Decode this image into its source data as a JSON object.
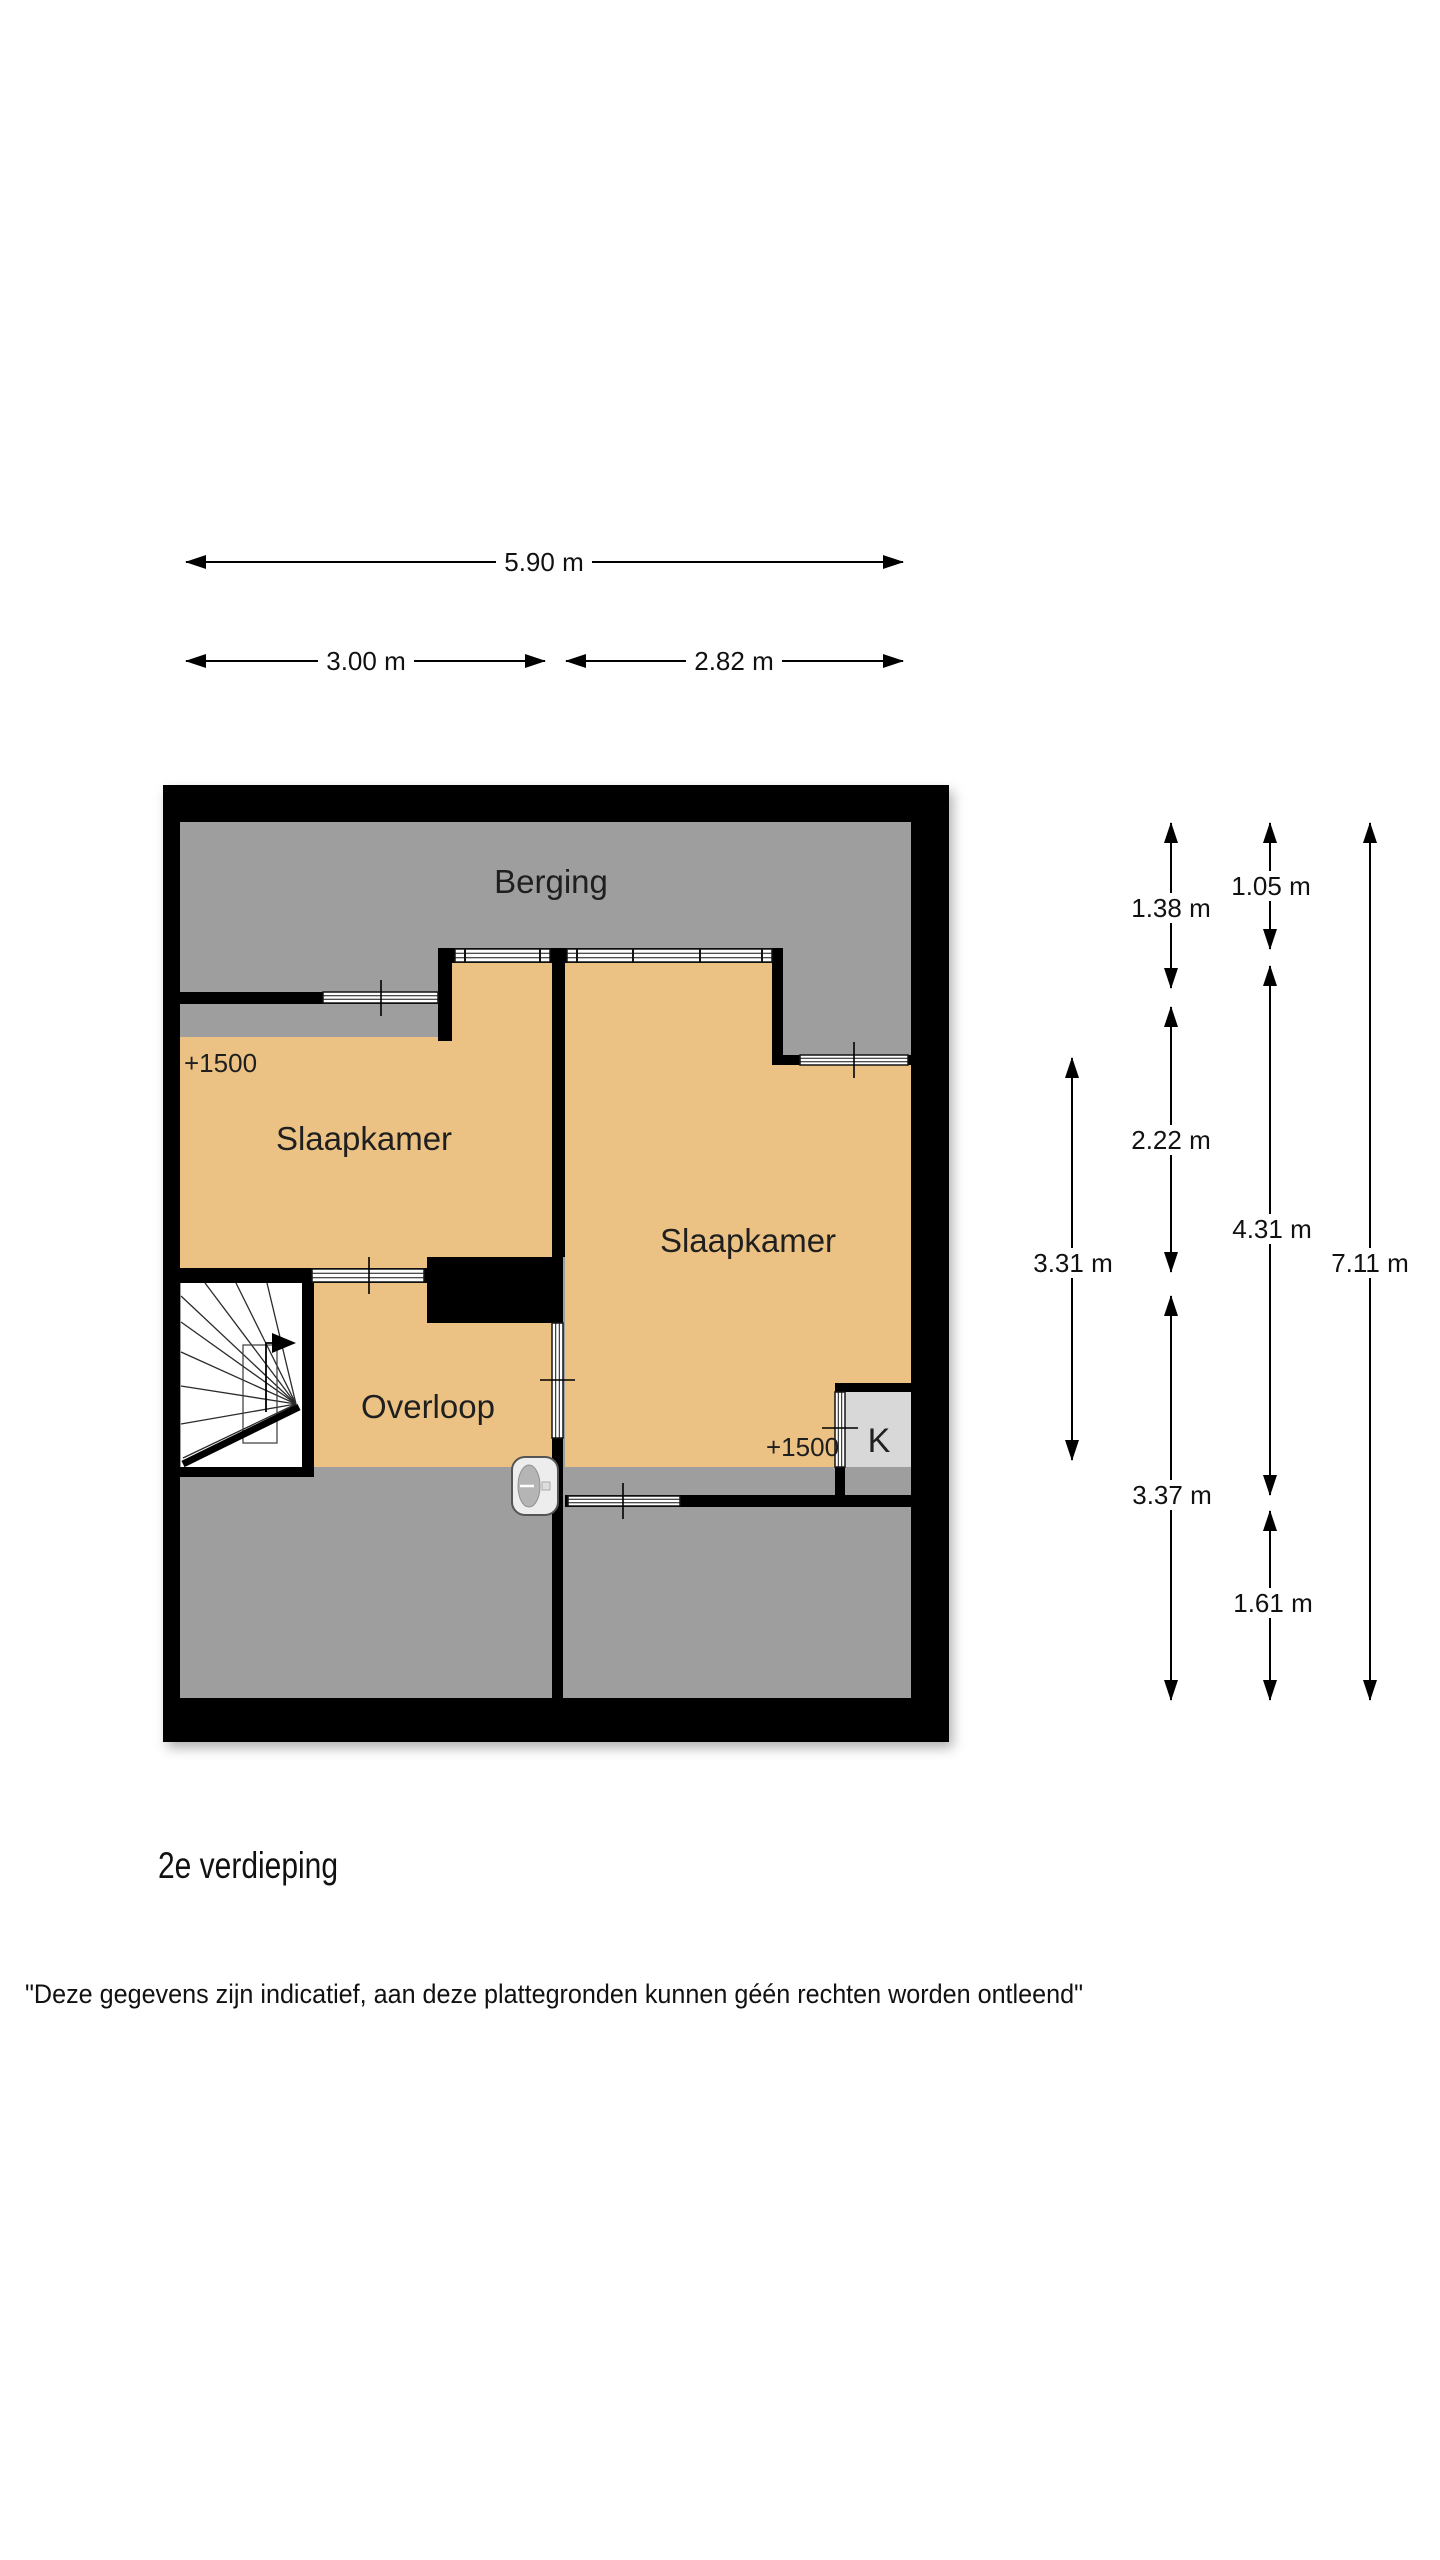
{
  "colors": {
    "wall": "#000000",
    "area_gray": "#9e9e9e",
    "room_orange": "#ebc283",
    "closet_gray": "#d8d8d8",
    "page_background": "#ffffff",
    "label_ink": "#1f1f1f"
  },
  "rooms": {
    "berging": "Berging",
    "slaapkamer_left": "Slaapkamer",
    "slaapkamer_right": "Slaapkamer",
    "overloop": "Overloop",
    "closet": "K"
  },
  "height_markers": {
    "left": "+1500",
    "right": "+1500"
  },
  "dimensions": {
    "top": {
      "total": "5.90 m",
      "left": "3.00 m",
      "right": "2.82 m"
    },
    "side": {
      "inner": "3.31 m",
      "a1": "1.38 m",
      "a2": "2.22 m",
      "a3": "3.37 m",
      "b1": "1.05 m",
      "b2": "4.31 m",
      "b3": "1.61 m",
      "outer": "7.11 m"
    }
  },
  "footer": {
    "floor_label": "2e verdieping",
    "disclaimer": "\"Deze gegevens zijn indicatief, aan deze plattegronden kunnen géén rechten worden ontleend\""
  }
}
